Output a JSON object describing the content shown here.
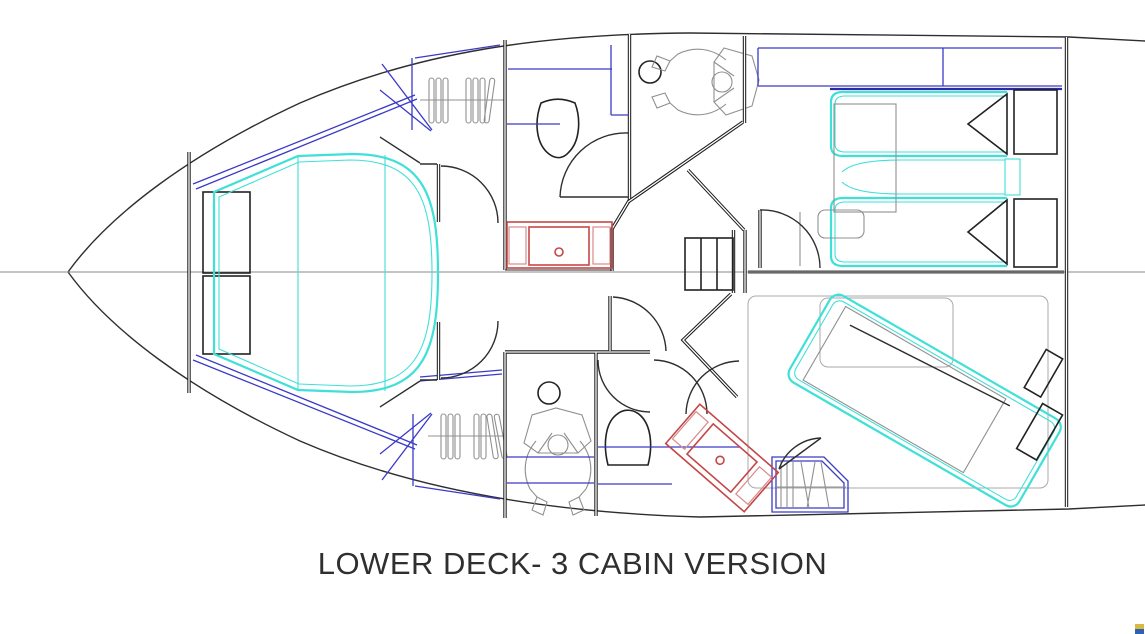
{
  "title": {
    "text": "LOWER DECK- 3 CABIN VERSION"
  },
  "palette": {
    "background": "#ffffff",
    "hull_line": "#2e2e2e",
    "wall_line": "#1c1c1c",
    "detail_gray": "#909090",
    "room_gray": "#aaaaaa",
    "furniture_cyan": "#3fe0d8",
    "cabinet_blue": "#3a3ac8",
    "shelf_blue_dark": "#2a2aa8",
    "fixture_red": "#c44747",
    "fixture_red_light": "#d98a8a",
    "centerline_gray": "#8a8a8a",
    "centerline_bold": "#686868",
    "title_color": "#2f2f2f",
    "watermark_yellow": "#d9ba3e",
    "watermark_blue": "#2d63b2"
  }
}
